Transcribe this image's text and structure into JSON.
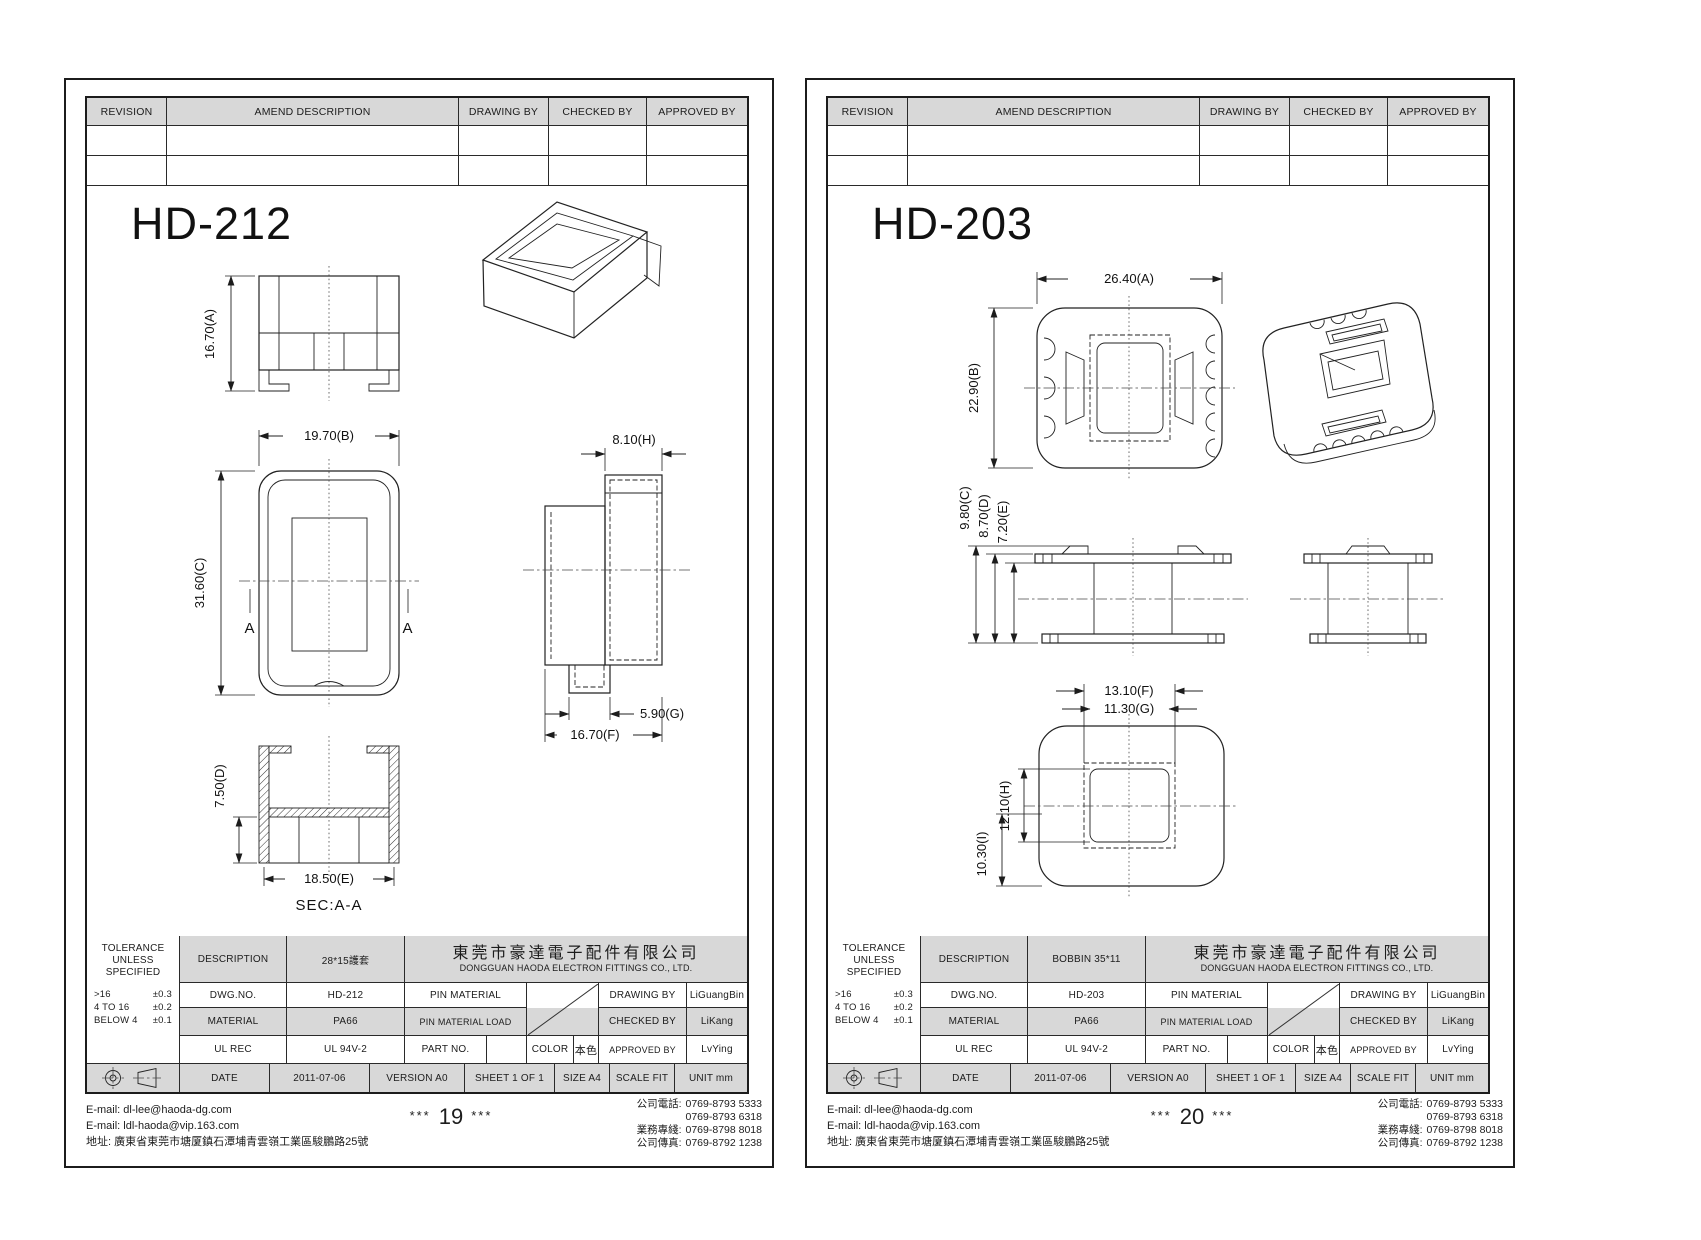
{
  "colors": {
    "cell_gray": "#d8d8d8",
    "line": "#1c1c1c",
    "paper": "#ffffff"
  },
  "labels": {
    "rev": {
      "revision": "REVISION",
      "amend": "AMEND DESCRIPTION",
      "drawing": "DRAWING BY",
      "checked": "CHECKED BY",
      "approved": "APPROVED BY"
    },
    "blk": {
      "tol1": "TOLERANCE",
      "tol2": "UNLESS",
      "tol3": "SPECIFIED",
      "tol_rows": [
        {
          "range": ">16",
          "tol": "±0.3"
        },
        {
          "range": "4 TO 16",
          "tol": "±0.2"
        },
        {
          "range": "BELOW 4",
          "tol": "±0.1"
        }
      ],
      "description": "DESCRIPTION",
      "dwg_no": "DWG.NO.",
      "material": "MATERIAL",
      "ul_rec": "UL REC",
      "date": "DATE",
      "pin_material": "PIN MATERIAL",
      "pin_material_load": "PIN MATERIAL LOAD",
      "part_no": "PART NO.",
      "color": "COLOR",
      "drawing_by": "DRAWING BY",
      "checked_by": "CHECKED BY",
      "approved_by": "APPROVED BY"
    }
  },
  "company": {
    "cn": "東莞市豪達電子配件有限公司",
    "en": "DONGGUAN HAODA ELECTRON FITTINGS CO., LTD."
  },
  "vals": {
    "material": "PA66",
    "ul": "UL 94V-2",
    "color": "本色",
    "date": "2011-07-06",
    "version": "VERSION A0",
    "sheet": "SHEET 1 OF 1",
    "size": "SIZE A4",
    "scale": "SCALE FIT",
    "unit": "UNIT mm",
    "drawer": "LiGuangBin",
    "checker": "LiKang",
    "approver": "LvYing"
  },
  "footer": {
    "email1": "E-mail: dl-lee@haoda-dg.com",
    "email2": "E-mail: ldl-haoda@vip.163.com",
    "address": "地址: 廣東省東莞市塘厦鎮石潭埔青雲嶺工業區駿鵬路25號",
    "stars": "***",
    "phone_label": "公司電話:",
    "phone1": "0769-8793 5333",
    "phone2": "0769-8793 6318",
    "biz_label": "業務專綫:",
    "biz": "0769-8798 8018",
    "fax_label": "公司傳真:",
    "fax": "0769-8792 1238"
  },
  "page1": {
    "title": "HD-212",
    "description": "28*15護套",
    "dwg_no": "HD-212",
    "page_no": "19",
    "section_label": "SEC:A-A",
    "a_mark": "A",
    "dims": {
      "a": "16.70(A)",
      "b": "19.70(B)",
      "c": "31.60(C)",
      "d": "7.50(D)",
      "e": "18.50(E)",
      "f": "16.70(F)",
      "g": "5.90(G)",
      "h": "8.10(H)"
    }
  },
  "page2": {
    "title": "HD-203",
    "description": "BOBBIN 35*11",
    "dwg_no": "HD-203",
    "page_no": "20",
    "dims": {
      "a": "26.40(A)",
      "b": "22.90(B)",
      "c": "9.80(C)",
      "d": "8.70(D)",
      "e": "7.20(E)",
      "f": "13.10(F)",
      "g": "11.30(G)",
      "h": "12.10(H)",
      "i": "10.30(I)"
    }
  }
}
